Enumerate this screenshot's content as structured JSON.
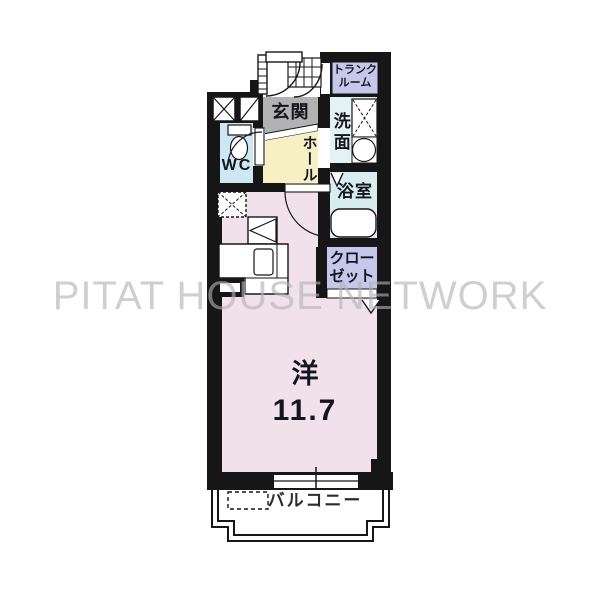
{
  "floorplan": {
    "title_watermark": "PITAT HOUSE NETWORK",
    "rooms": {
      "entrance": {
        "label": "玄関"
      },
      "trunk_room": {
        "line1": "トランク",
        "line2": "ルーム"
      },
      "washroom": {
        "label": "洗面"
      },
      "bathroom": {
        "label": "浴室"
      },
      "wc": {
        "label": "WC"
      },
      "hall": {
        "label": "ホール"
      },
      "closet": {
        "line1": "クロー",
        "line2": "ゼット"
      },
      "western_room": {
        "type": "洋",
        "size": "11.7"
      },
      "balcony": {
        "label": "バルコニー"
      }
    },
    "colors": {
      "wall": "#161616",
      "entrance_gray": "#b2b2b2",
      "hall_yellow": "#f6f0c2",
      "wc_blue": "#cde8f2",
      "washroom_cyan": "#e3f2f4",
      "bathroom_cyan": "#d7edf0",
      "closet_lavender": "#c7c7eb",
      "trunk_lavender": "#c7c7eb",
      "room_pink": "#f1e1eb"
    }
  }
}
